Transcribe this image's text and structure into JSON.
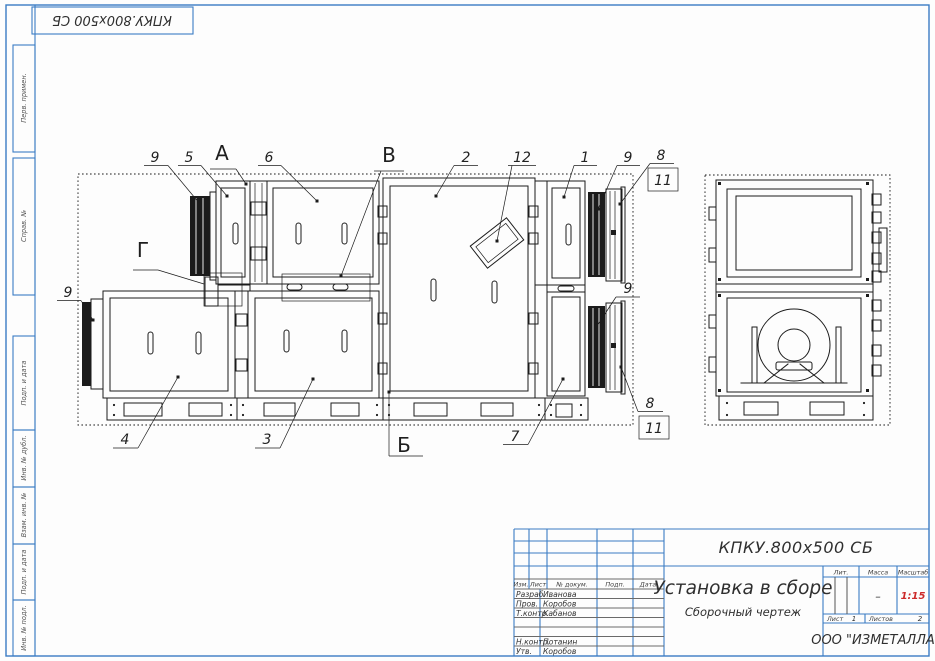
{
  "corner_stamp": "КПКУ.800х500 СБ",
  "margin_fields": {
    "perv": "Перв. примен.",
    "sprav": "Справ. №",
    "podp1": "Подп. и дата",
    "inv_dubl": "Инв. № дубл.",
    "vzam": "Взам. инв. №",
    "podp2": "Подп. и дата",
    "inv_podl": "Инв. № подл."
  },
  "callouts": {
    "zones": {
      "a": "А",
      "b": "Б",
      "v": "В",
      "g": "Г"
    },
    "positions": {
      "p1": "1",
      "p2": "2",
      "p3": "3",
      "p4": "4",
      "p5": "5",
      "p6": "6",
      "p7": "7",
      "p8": "8",
      "p9": "9",
      "p11": "11",
      "p12": "12"
    }
  },
  "title_block": {
    "doc_number": "КПКУ.800х500 СБ",
    "name": "Установка в сборе",
    "doc_type": "Сборочный чертеж",
    "company": "ООО \"ИЗМЕТАЛЛА\"",
    "scale": "1:15",
    "mass": "–",
    "sheet": "1",
    "sheets": "2",
    "headers": {
      "izm": "Изм.",
      "list": "Лист",
      "doc": "№ докум.",
      "podp": "Подп.",
      "date": "Дата",
      "lit": "Лит.",
      "mass": "Масса",
      "scale": "Масштаб",
      "sheet": "Лист",
      "sheets": "Листов"
    },
    "signature_rows": [
      {
        "role": "Разраб.",
        "name": "Иванова"
      },
      {
        "role": "Пров.",
        "name": "Коробов"
      },
      {
        "role": "Т.контр.",
        "name": "Кабанов"
      },
      {
        "role": "",
        "name": ""
      },
      {
        "role": "",
        "name": ""
      },
      {
        "role": "Н.контр.",
        "name": "Потанин"
      },
      {
        "role": "Утв.",
        "name": "Коробов"
      }
    ]
  },
  "colors": {
    "frame_blue": "#3b7cc4",
    "line_black": "#1c1c1c",
    "scale_red": "#cc2a2a"
  }
}
